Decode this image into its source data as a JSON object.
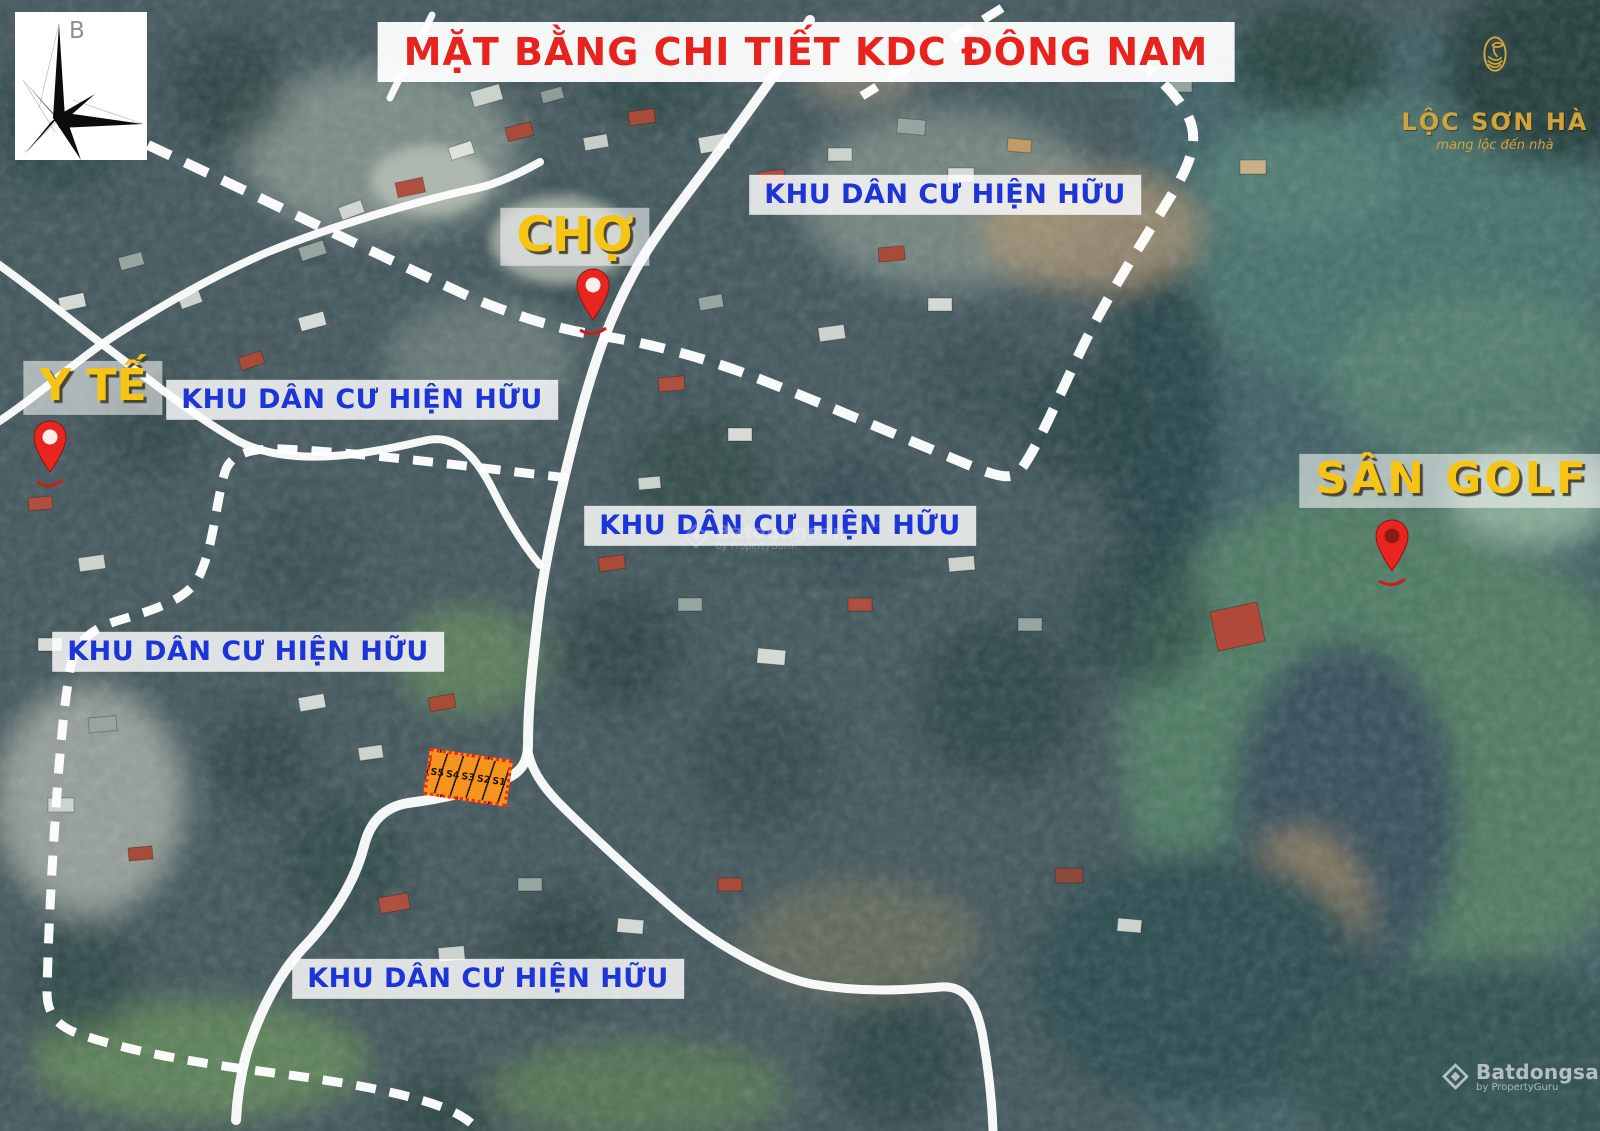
{
  "title": "MẶT BẰNG CHI TIẾT KDC ĐÔNG NAM",
  "compass": {
    "north_label": "B"
  },
  "brand": {
    "name": "LỘC SƠN HÀ",
    "tagline": "mang lộc đến nhà"
  },
  "map_labels": {
    "market": "CHỢ",
    "medical": "Y TẾ",
    "golf": "SÂN GOLF",
    "residential": "KHU DÂN CƯ HIỆN HỮU"
  },
  "lots": {
    "ids": [
      "S5",
      "S4",
      "S3",
      "S2",
      "S1"
    ]
  },
  "watermark": {
    "name": "Batdongsan",
    "domain": "com.vn",
    "byline": "by PropertyGuru"
  },
  "colors": {
    "title_red": "#e8231e",
    "label_blue": "#1d35d6",
    "label_yellow": "#f6c514",
    "lot_orange": "#f7941d",
    "lot_border_red": "#ff2217",
    "pin_red": "#e8251f",
    "brand_gold": "#d2a33a"
  }
}
